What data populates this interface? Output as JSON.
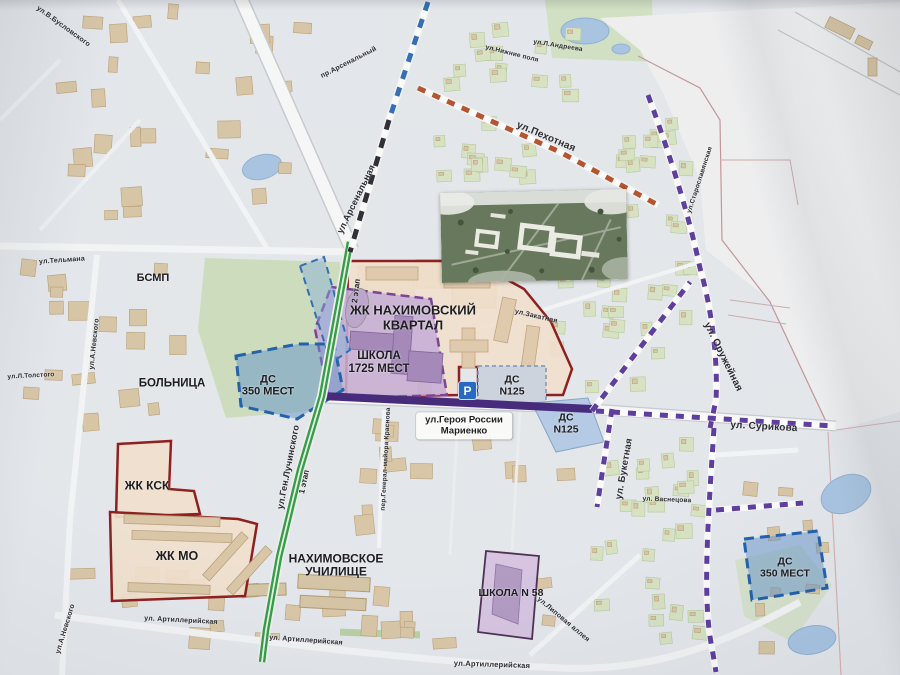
{
  "labels": {
    "nakh_quarter": {
      "line1": "ЖК НАХИМОВСКИЙ",
      "line2": "КВАРТАЛ"
    },
    "school1725": {
      "line1": "ШКОЛА",
      "line2": "1725 МЕСТ"
    },
    "ds350_left": {
      "line1": "ДС",
      "line2": "350 МЕСТ"
    },
    "ds125_a": {
      "line1": "ДС",
      "line2": "N125"
    },
    "ds125_b": {
      "line1": "ДС",
      "line2": "N125"
    },
    "ds350_right": {
      "line1": "ДС",
      "line2": "350 МЕСТ"
    },
    "zhk_ksk": {
      "text": "ЖК КСК"
    },
    "zhk_mo": {
      "text": "ЖК МО"
    },
    "school58": {
      "text": "ШКОЛА N 58"
    },
    "college": {
      "line1": "НАХИМОВСКОЕ",
      "line2": "УЧИЛИЩЕ"
    },
    "bsmp": {
      "text": "БСМП"
    },
    "hospital": {
      "text": "БОЛЬНИЦА"
    },
    "marienko": {
      "line1": "ул.Героя России",
      "line2": "Мариенко"
    },
    "stage1": {
      "text": "1 этап"
    },
    "stage2": {
      "text": "2 этап"
    },
    "parking": {
      "text": "P"
    }
  },
  "streets": {
    "pekhotnaya": "ул.Пехотная",
    "arsenalnaya": "ул.Арсенальная",
    "arsenalny_pr": "пр.Арсенальный",
    "oruzheynaya": "ул. Оружейная",
    "surikova": "ул. Сурикова",
    "buketnaya": "ул. Букетная",
    "luchinskogo": "ул.Ген.Лучинского",
    "telmana": "ул.Тельмана",
    "nevskogo1": "ул.А.Невского",
    "nevskogo2": "ул.А.Невского",
    "artiller1": "ул. Артиллерийская",
    "artiller2": "ул. Артиллерийская",
    "artiller3": "ул.Артиллерийская",
    "lipovaya": "ул.Липовая аллея",
    "zakatnaya": "ул.Закатная",
    "krasnova": "пер.Генерал-майора Краснова",
    "vasnetsova": "ул. Васнецова",
    "andreeva": "ул.Л.Андреева",
    "nizhnie": "ул.Нижние поля",
    "buslovskogo": "ул.В.Бусловского",
    "tolstogo": "ул.Л.Толстого",
    "staroslav": "ул.Старославянская"
  },
  "colors": {
    "zone_red_border": "#8e1a1a",
    "zone_cream_fill": "#f4e3d0",
    "school_purple_fill": "#c7afd9",
    "school_purple_border": "#7a3f98",
    "kindergarten_blue_fill": "#6092cd",
    "kindergarten_blue_border": "#1d5fae",
    "route_green": "#2f9e44",
    "route_purple": "#5b3aa0",
    "route_red_brown": "#b5502c",
    "rail_blue": "#2f6db8",
    "main_road_purple": "#43267c",
    "parking_blue": "#2268c4"
  }
}
